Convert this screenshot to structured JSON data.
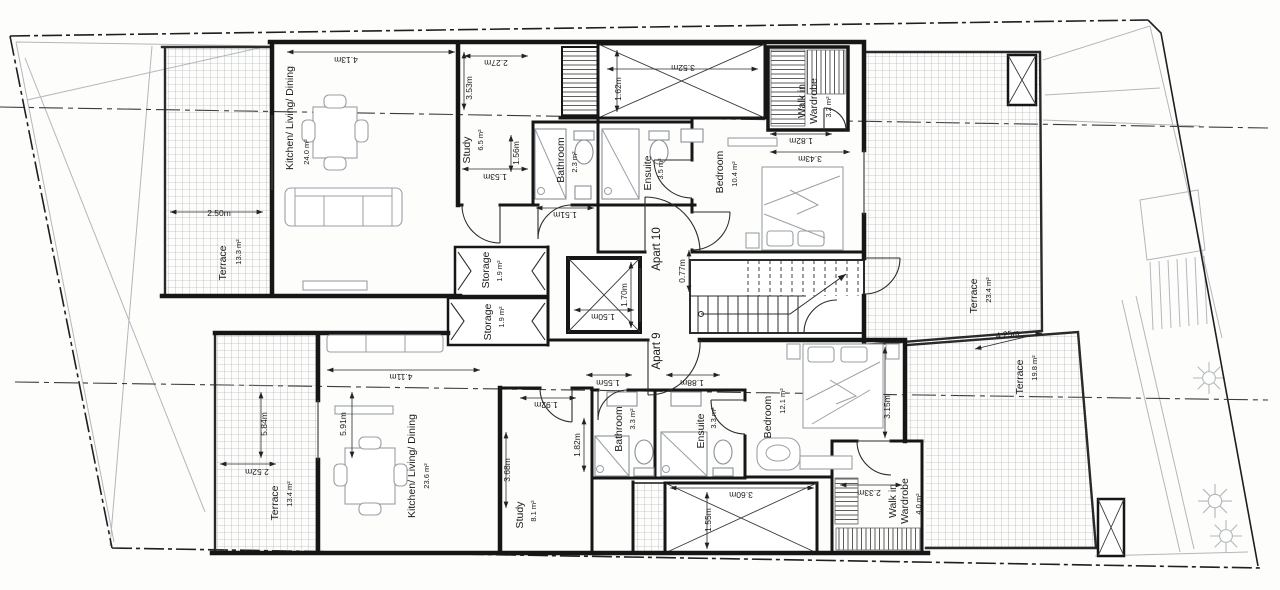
{
  "plan": {
    "type": "architectural-floor-plan",
    "apartments": [
      "Apart 9",
      "Apart 10"
    ],
    "apartment_labels": [
      {
        "id": "apart-10-label",
        "text": "Apart 10",
        "x": 660,
        "y": 249,
        "r": -90
      },
      {
        "id": "apart-9-label",
        "text": "Apart 9",
        "x": 660,
        "y": 351,
        "r": -90
      }
    ],
    "room_labels": [
      {
        "id": "room-kitchen-living-dining-upper",
        "text": "Kitchen/ Living/ Dining",
        "x": 293,
        "y": 118,
        "r": -90
      },
      {
        "id": "room-terrace-upper-left",
        "text": "Terrace",
        "x": 226,
        "y": 263,
        "r": -90
      },
      {
        "id": "room-study-upper",
        "text": "Study",
        "x": 470,
        "y": 150,
        "r": -90
      },
      {
        "id": "room-bathroom-upper",
        "text": "Bathroom",
        "x": 564,
        "y": 160,
        "r": -90
      },
      {
        "id": "room-ensuite-upper",
        "text": "Ensuite",
        "x": 651,
        "y": 173,
        "r": -90
      },
      {
        "id": "room-bedroom-upper",
        "text": "Bedroom",
        "x": 723,
        "y": 172,
        "r": -90
      },
      {
        "id": "room-walkin-upper-line1",
        "text": "Walk in",
        "x": 805,
        "y": 101,
        "r": -90
      },
      {
        "id": "room-walkin-upper-line2",
        "text": "Wardrobe",
        "x": 817,
        "y": 101,
        "r": -90
      },
      {
        "id": "room-terrace-upper-right",
        "text": "Terrace",
        "x": 977,
        "y": 296,
        "r": -90
      },
      {
        "id": "room-storage-upper",
        "text": "Storage",
        "x": 489,
        "y": 270,
        "r": -90
      },
      {
        "id": "room-storage-lower",
        "text": "Storage",
        "x": 491,
        "y": 322,
        "r": -90
      },
      {
        "id": "room-kitchen-living-dining-lower",
        "text": "Kitchen/ Living/ Dining",
        "x": 415,
        "y": 466,
        "r": -90
      },
      {
        "id": "room-terrace-lower-left",
        "text": "Terrace",
        "x": 278,
        "y": 503,
        "r": -90
      },
      {
        "id": "room-study-lower",
        "text": "Study",
        "x": 523,
        "y": 515,
        "r": -90
      },
      {
        "id": "room-bathroom-lower",
        "text": "Bathroom",
        "x": 622,
        "y": 429,
        "r": -90
      },
      {
        "id": "room-ensuite-lower",
        "text": "Ensuite",
        "x": 704,
        "y": 431,
        "r": -90
      },
      {
        "id": "room-bedroom-lower",
        "text": "Bedroom",
        "x": 771,
        "y": 417,
        "r": -90
      },
      {
        "id": "room-walkin-lower-line1",
        "text": "Walk in",
        "x": 896,
        "y": 501,
        "r": -90
      },
      {
        "id": "room-walkin-lower-line2",
        "text": "Wardrobe",
        "x": 908,
        "y": 501,
        "r": -90
      },
      {
        "id": "room-terrace-lower-right",
        "text": "Terrace",
        "x": 1023,
        "y": 377,
        "r": -90
      }
    ],
    "area_labels": [
      {
        "id": "area-kitchen-upper",
        "text": "24.0 m²",
        "x": 309,
        "y": 152,
        "r": -90
      },
      {
        "id": "area-terrace-upper-left",
        "text": "13.3 m²",
        "x": 241,
        "y": 252,
        "r": -90
      },
      {
        "id": "area-study-upper",
        "text": "6.5 m²",
        "x": 483,
        "y": 140,
        "r": -90
      },
      {
        "id": "area-bathroom-upper",
        "text": "2.3 m²",
        "x": 577,
        "y": 162,
        "r": -90
      },
      {
        "id": "area-ensuite-upper",
        "text": "3.5 m²",
        "x": 663,
        "y": 169,
        "r": -90
      },
      {
        "id": "area-bedroom-upper",
        "text": "10.4 m²",
        "x": 737,
        "y": 174,
        "r": -90
      },
      {
        "id": "area-walkin-upper",
        "text": "3.2 m²",
        "x": 831,
        "y": 107,
        "r": -90
      },
      {
        "id": "area-terrace-upper-right",
        "text": "23.4 m²",
        "x": 991,
        "y": 290,
        "r": -90
      },
      {
        "id": "area-storage-upper",
        "text": "1.9 m²",
        "x": 502,
        "y": 271,
        "r": -90
      },
      {
        "id": "area-storage-lower",
        "text": "1.9 m²",
        "x": 504,
        "y": 317,
        "r": -90
      },
      {
        "id": "area-kitchen-lower",
        "text": "23.6 m²",
        "x": 429,
        "y": 476,
        "r": -90
      },
      {
        "id": "area-terrace-lower-left",
        "text": "13.4 m²",
        "x": 292,
        "y": 494,
        "r": -90
      },
      {
        "id": "area-study-lower",
        "text": "8.1 m²",
        "x": 536,
        "y": 511,
        "r": -90
      },
      {
        "id": "area-bathroom-lower",
        "text": "3.3 m²",
        "x": 635,
        "y": 419,
        "r": -90
      },
      {
        "id": "area-ensuite-lower",
        "text": "3.3 m²",
        "x": 716,
        "y": 418,
        "r": -90
      },
      {
        "id": "area-bedroom-lower",
        "text": "12.1 m²",
        "x": 785,
        "y": 401,
        "r": -90
      },
      {
        "id": "area-walkin-lower",
        "text": "4.0 m²",
        "x": 921,
        "y": 504,
        "r": -90
      },
      {
        "id": "area-terrace-lower-right",
        "text": "19.8 m²",
        "x": 1037,
        "y": 368,
        "r": -90
      }
    ],
    "dimension_labels": [
      {
        "id": "dim-4-13m",
        "text": "4.13m",
        "x": 346,
        "y": 57,
        "r": 180
      },
      {
        "id": "dim-2-50m",
        "text": "2.50m",
        "x": 219,
        "y": 216,
        "r": 0
      },
      {
        "id": "dim-3-53m",
        "text": "3.53m",
        "x": 472,
        "y": 88,
        "r": -90
      },
      {
        "id": "dim-2-27m",
        "text": "2.27m",
        "x": 496,
        "y": 60,
        "r": 180
      },
      {
        "id": "dim-1-56m",
        "text": "1.56m",
        "x": 519,
        "y": 153,
        "r": -90
      },
      {
        "id": "dim-1-53m",
        "text": "1.53m",
        "x": 495,
        "y": 174,
        "r": 180
      },
      {
        "id": "dim-1-51m",
        "text": "1.51m",
        "x": 565,
        "y": 212,
        "r": 180
      },
      {
        "id": "dim-3-52m",
        "text": "3.52m",
        "x": 683,
        "y": 65,
        "r": 180
      },
      {
        "id": "dim-1-62m",
        "text": "1.62m",
        "x": 621,
        "y": 89,
        "r": -90
      },
      {
        "id": "dim-1-82m-upper",
        "text": "1.82m",
        "x": 801,
        "y": 138,
        "r": 180
      },
      {
        "id": "dim-3-43m",
        "text": "3.43m",
        "x": 810,
        "y": 156,
        "r": 180
      },
      {
        "id": "dim-4-25m",
        "text": "4.25m",
        "x": 1008,
        "y": 337,
        "r": -8
      },
      {
        "id": "dim-1-50m",
        "text": "1.50m",
        "x": 603,
        "y": 314,
        "r": 180
      },
      {
        "id": "dim-1-70m",
        "text": "1.70m",
        "x": 627,
        "y": 295,
        "r": -90
      },
      {
        "id": "dim-0-77m",
        "text": "0.77m",
        "x": 685,
        "y": 271,
        "r": -90
      },
      {
        "id": "dim-1-55m-hall",
        "text": "1.55m",
        "x": 608,
        "y": 380,
        "r": 180
      },
      {
        "id": "dim-1-88m",
        "text": "1.88m",
        "x": 692,
        "y": 380,
        "r": 180
      },
      {
        "id": "dim-4-11m",
        "text": "4.11m",
        "x": 401,
        "y": 374,
        "r": 180
      },
      {
        "id": "dim-5-91m",
        "text": "5.91m",
        "x": 346,
        "y": 424,
        "r": -90
      },
      {
        "id": "dim-5-84m",
        "text": "5.84m",
        "x": 267,
        "y": 424,
        "r": -90
      },
      {
        "id": "dim-2-52m",
        "text": "2.52m",
        "x": 257,
        "y": 469,
        "r": 180
      },
      {
        "id": "dim-3-68m",
        "text": "3.68m",
        "x": 510,
        "y": 470,
        "r": -90
      },
      {
        "id": "dim-1-92m",
        "text": "1.92m",
        "x": 546,
        "y": 402,
        "r": 180
      },
      {
        "id": "dim-1-82m-lower",
        "text": "1.82m",
        "x": 580,
        "y": 445,
        "r": -90
      },
      {
        "id": "dim-3-60m",
        "text": "3.60m",
        "x": 741,
        "y": 492,
        "r": 180
      },
      {
        "id": "dim-1-55m-void",
        "text": "1.55m",
        "x": 711,
        "y": 520,
        "r": -90
      },
      {
        "id": "dim-2-33m",
        "text": "2.33m",
        "x": 869,
        "y": 490,
        "r": 180
      },
      {
        "id": "dim-3-15m",
        "text": "3.15m",
        "x": 890,
        "y": 407,
        "r": -90
      }
    ]
  }
}
